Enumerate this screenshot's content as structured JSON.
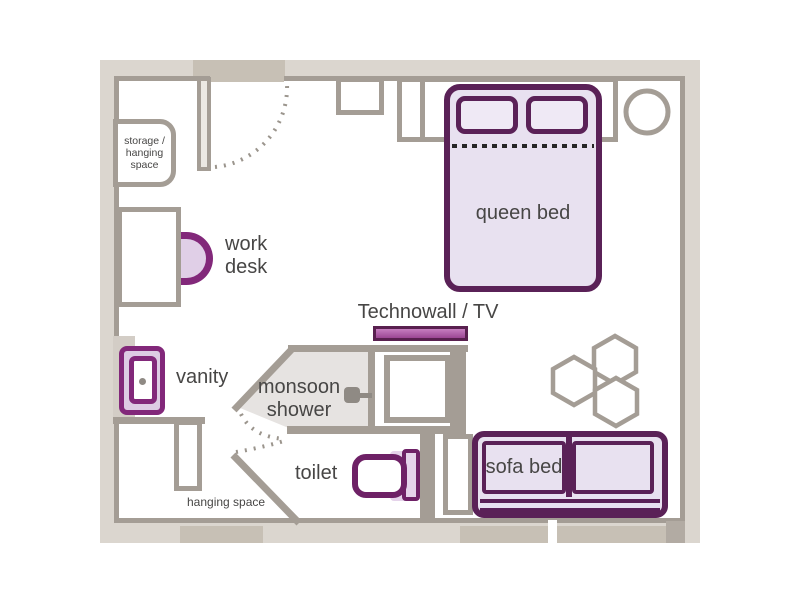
{
  "plan": {
    "labels": {
      "storage": [
        "storage /",
        "hanging",
        "space"
      ],
      "work_desk": [
        "work",
        "desk"
      ],
      "vanity": "vanity",
      "monsoon_shower": [
        "monsoon",
        "shower"
      ],
      "toilet": "toilet",
      "hanging_space": "hanging space",
      "technowall": "Technowall / TV",
      "queen_bed": "queen bed",
      "sofa_bed": "sofa bed"
    },
    "icons": {
      "shower_head": "shower-head-icon",
      "door_swing": "dotted-door-swing-arc",
      "stool": "round-stool",
      "hex_shelves": "hexagon-shelf-cluster"
    },
    "colors": {
      "wall_stroke": "#a49d95",
      "wall_fill": "#dbd6cf",
      "wall_dark": "#c7c0b5",
      "furniture_purple": "#5a2157",
      "fixture_purple": "#82287a",
      "tv_magenta": "#a4509c",
      "lavender_fill": "#e8e1f0",
      "shower_floor": "#e6e3e1",
      "text": "#474645"
    }
  }
}
